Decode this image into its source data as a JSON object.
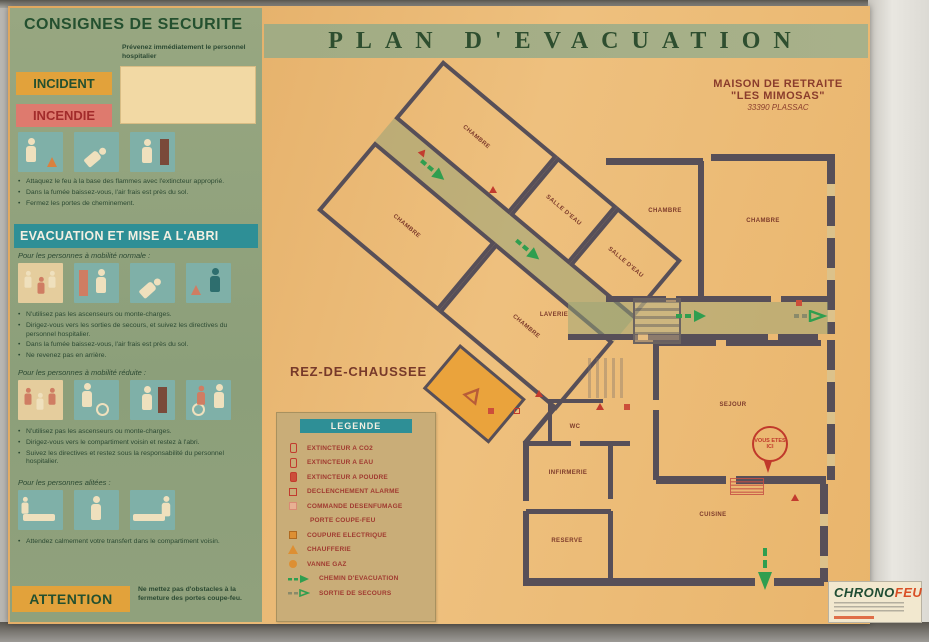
{
  "sign": {
    "title": "PLAN D'EVACUATION",
    "facility": {
      "line1": "MAISON DE RETRAITE",
      "line2": "\"LES MIMOSAS\"",
      "line3": "33390 PLASSAC"
    },
    "floor_label": "REZ-DE-CHAUSSEE"
  },
  "left_panel": {
    "title": "CONSIGNES DE SECURITE",
    "intro": "Prévenez immédiatement le personnel hospitalier",
    "incident_label": "INCIDENT",
    "incendie_label": "INCENDIE",
    "fire_bullets": [
      "Attaquez le feu à la base des flammes avec l'extincteur approprié.",
      "Dans la fumée baissez-vous, l'air frais est près du sol.",
      "Fermez les portes de cheminement."
    ],
    "evacuation_title": "EVACUATION ET MISE A L'ABRI",
    "mobility_normal_label": "Pour les personnes à mobilité normale :",
    "mobility_normal_bullets": [
      "N'utilisez pas les ascenseurs ou monte-charges.",
      "Dirigez-vous vers les sorties de secours, et suivez les directives du personnel hospitalier.",
      "Dans la fumée baissez-vous, l'air frais est près du sol.",
      "Ne revenez pas en arrière."
    ],
    "mobility_reduced_label": "Pour les personnes à mobilité réduite :",
    "mobility_reduced_bullets": [
      "N'utilisez pas les ascenseurs ou monte-charges.",
      "Dirigez-vous vers le compartiment voisin et restez à l'abri.",
      "Suivez les directives et restez sous la responsabilité du personnel hospitalier."
    ],
    "bedridden_label": "Pour les personnes alitées :",
    "bedridden_bullets": [
      "Attendez calmement votre transfert dans le compartiment voisin."
    ],
    "attention_label": "ATTENTION",
    "attention_text": "Ne mettez pas d'obstacles à la fermeture des portes coupe-feu."
  },
  "legend": {
    "title": "LEGENDE",
    "items": [
      {
        "label": "EXTINCTEUR A CO2"
      },
      {
        "label": "EXTINCTEUR A EAU"
      },
      {
        "label": "EXTINCTEUR A POUDRE"
      },
      {
        "label": "DECLENCHEMENT ALARME"
      },
      {
        "label": "COMMANDE DESENFUMAGE"
      },
      {
        "label": "PORTE COUPE-FEU"
      },
      {
        "label": "COUPURE ELECTRIQUE"
      },
      {
        "label": "CHAUFFERIE"
      },
      {
        "label": "VANNE GAZ"
      },
      {
        "label": "CHEMIN D'EVACUATION"
      },
      {
        "label": "SORTIE DE SECOURS"
      }
    ]
  },
  "plan": {
    "rooms": {
      "chambre": "CHAMBRE",
      "salle_eau": "SALLE D'EAU",
      "laverie": "LAVERIE",
      "sejour": "SEJOUR",
      "wc": "WC",
      "infirmerie": "INFIRMERIE",
      "reserve": "RESERVE",
      "cuisine": "CUISINE"
    },
    "you_are_here": "VOUS ETES ICI"
  },
  "logo": {
    "name_green": "CHRONO",
    "name_red": "FEU"
  },
  "colors": {
    "panel_green": "#93A37E",
    "sign_tan": "#E8B268",
    "band_green": "#A3AD85",
    "teal": "#2E8F96",
    "arrow_green": "#2F9E4F",
    "alert_red": "#C23B2E",
    "incident_orange": "#E2A23B",
    "incendie_red": "#DE7A6E",
    "wall": "#574F58"
  }
}
